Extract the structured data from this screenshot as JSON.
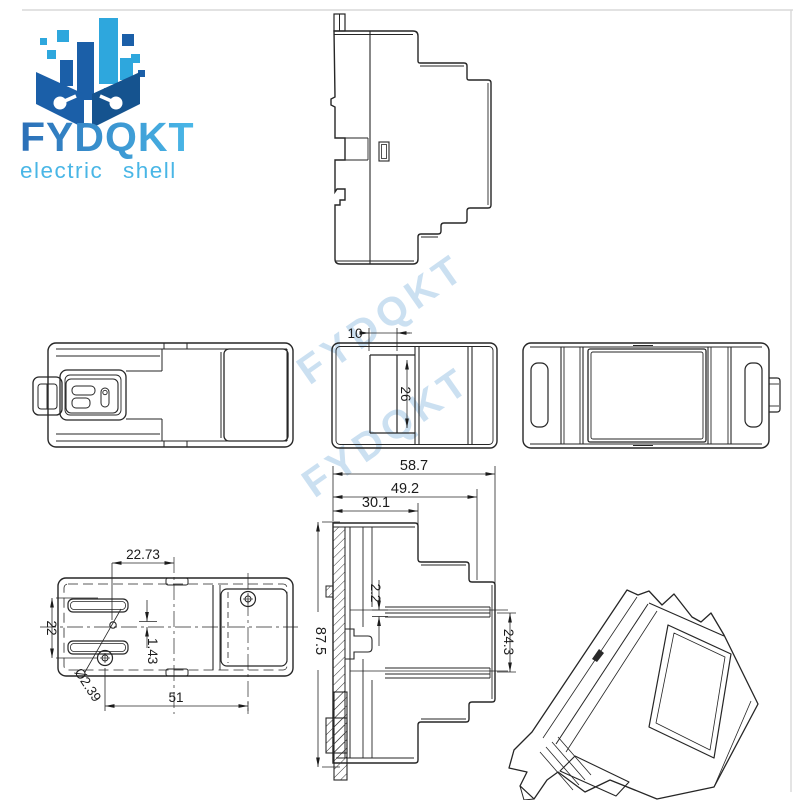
{
  "page": {
    "background": "#ffffff",
    "frame_border_color": "#d8d8d8"
  },
  "logo": {
    "title": "FYDQKT",
    "subtitle": "electric shell",
    "icon": "pixel-buildings-in-open-hands",
    "colors": {
      "dark_blue": "#1b5fa8",
      "deep_blue": "#15538f",
      "light_blue": "#2ea7dd",
      "title_gradient_start": "#2b6fb7",
      "title_gradient_end": "#4ab8e8",
      "subtitle_blue": "#49b6e6"
    }
  },
  "watermark": {
    "text": "FYDQKT",
    "color": "#a9cce9"
  },
  "views": {
    "side_profile": {
      "label": "side-profile-view"
    },
    "top_view": {
      "label": "top-view-with-din-clip"
    },
    "front_view": {
      "label": "front-view",
      "dims": {
        "slot_width": "10",
        "recess_height": "26"
      }
    },
    "back_view": {
      "label": "back-view"
    },
    "bottom_view": {
      "label": "bottom-view",
      "dims": {
        "hole_offset": "22.73",
        "screw_spacing_v": "22",
        "hole_to_center": "1.43",
        "hole_diameter": "Ø2.39",
        "screw_spacing_h": "51"
      }
    },
    "section_view": {
      "label": "section-view",
      "dims": {
        "overall_width": "58.7",
        "step_width": "49.2",
        "top_width": "30.1",
        "rail_slot": "2.2",
        "overall_height": "87.5",
        "rail_span": "24.3"
      }
    },
    "iso_view": {
      "label": "isometric-3d-view"
    }
  }
}
